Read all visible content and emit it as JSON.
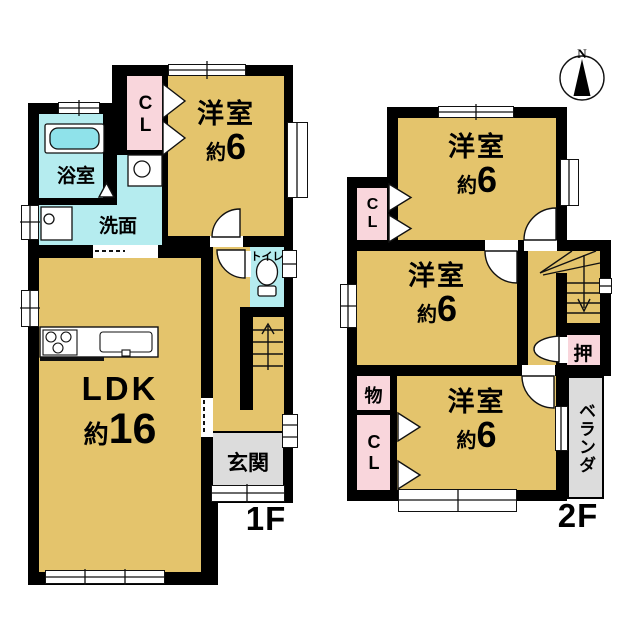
{
  "compass": {
    "north": "N"
  },
  "floor1": {
    "label": "1F",
    "rooms": {
      "western": {
        "name": "洋室",
        "size_prefix": "約",
        "size_value": "6"
      },
      "closet": {
        "label": "CL"
      },
      "bath": {
        "label": "浴室"
      },
      "washroom": {
        "label": "洗面"
      },
      "toilet": {
        "label": "トイレ"
      },
      "ldk": {
        "name": "LDK",
        "size_prefix": "約",
        "size_value": "16"
      },
      "entrance": {
        "label": "玄関"
      }
    }
  },
  "floor2": {
    "label": "2F",
    "rooms": {
      "western_north": {
        "name": "洋室",
        "size_prefix": "約",
        "size_value": "6"
      },
      "western_middle": {
        "name": "洋室",
        "size_prefix": "約",
        "size_value": "6"
      },
      "western_south": {
        "name": "洋室",
        "size_prefix": "約",
        "size_value": "6"
      },
      "closet_north": {
        "label": "CL"
      },
      "closet_south": {
        "label": "CL"
      },
      "storage": {
        "label": "物"
      },
      "oshiire": {
        "label": "押"
      },
      "veranda": {
        "label": "ベランダ"
      }
    }
  },
  "colors": {
    "room": "#E4C46C",
    "wet_area": "#B5ECEF",
    "bathtub": "#8FE2EA",
    "closet": "#F9D6DC",
    "entrance": "#DCDCDC",
    "wall": "#000000"
  }
}
